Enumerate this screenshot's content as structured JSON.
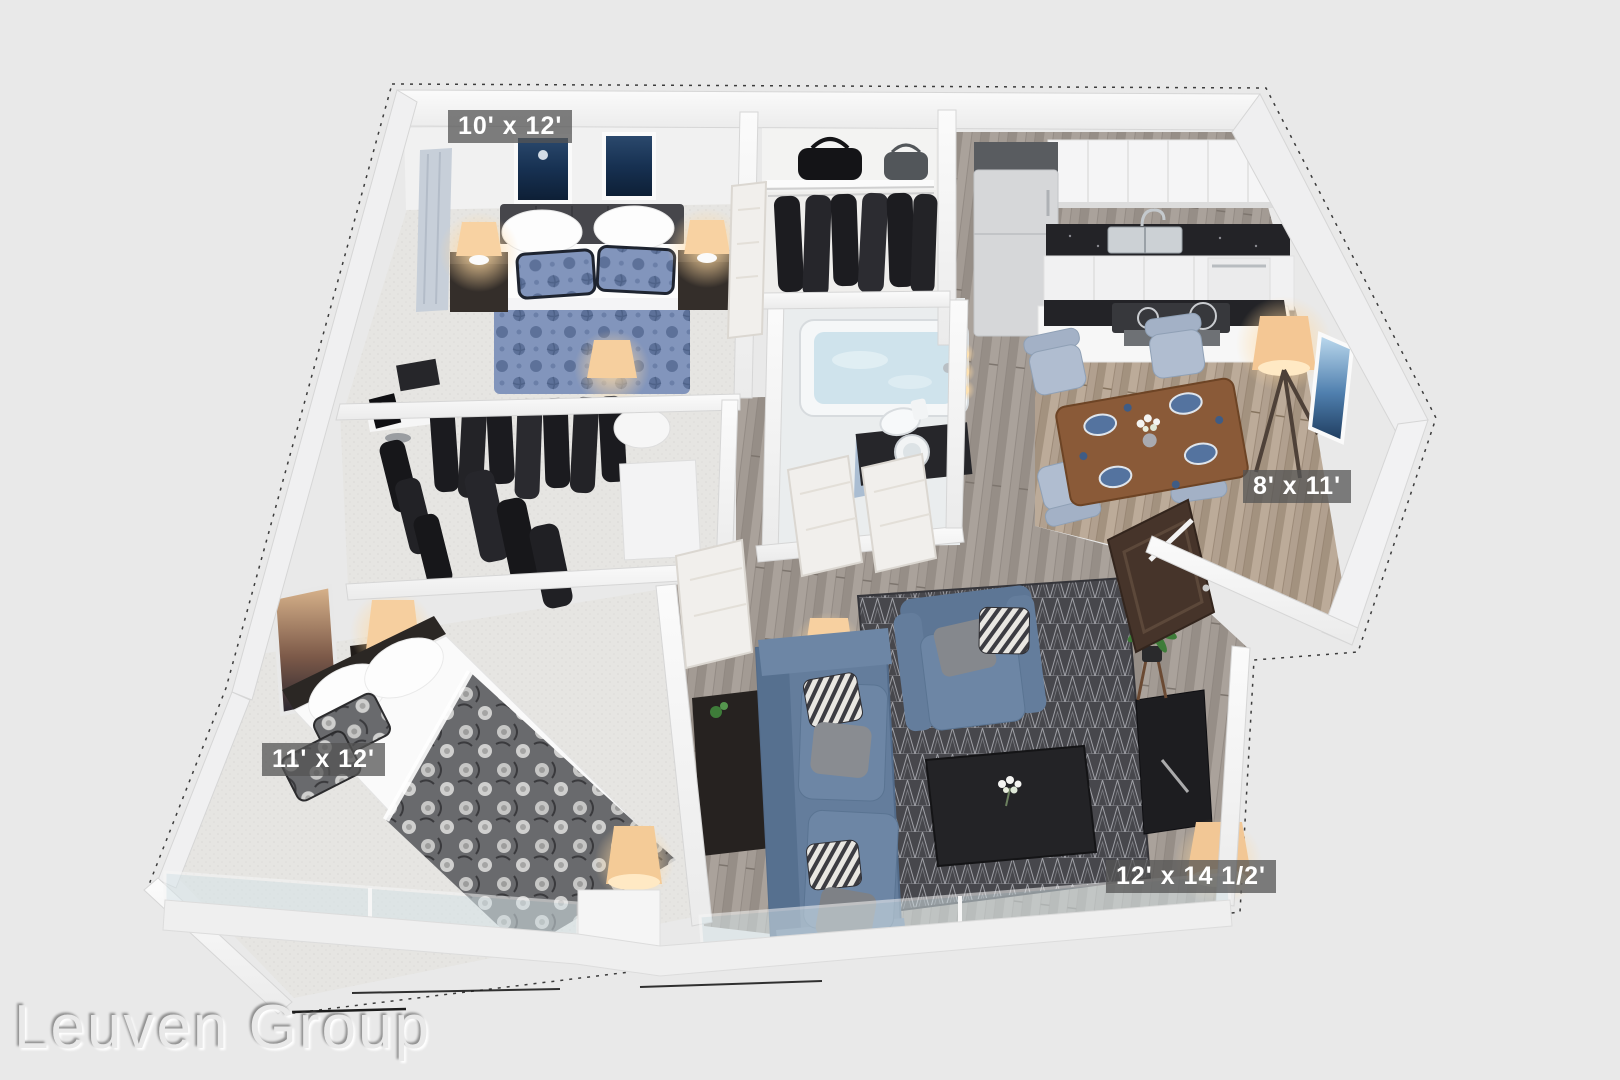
{
  "watermark": {
    "text": "Leuven Group"
  },
  "floorplan": {
    "type": "3d-apartment-floor-plan",
    "rooms": [
      {
        "id": "bedroom-1",
        "dimensions": "10' x 12'"
      },
      {
        "id": "dining-area",
        "dimensions": "8' x 11'"
      },
      {
        "id": "bedroom-2",
        "dimensions": "11' x 12'"
      },
      {
        "id": "living-room",
        "dimensions": "12' x 14 1/2'"
      }
    ],
    "colors": {
      "background": "#e9e9e9",
      "wall": "#f8f8f8",
      "label_background": "rgba(84,84,84,0.75)",
      "label_text": "#ffffff",
      "sofa_blue": "#6d86a5",
      "duvet_blue": "#8295bc",
      "duvet_gray": "#696a6d",
      "counter_black": "#232327",
      "dining_table_wood": "#8a5a38",
      "wood_floor": "#a39b94",
      "rug_dark": "#47474c",
      "lamp_glow": "#ffd9a0"
    }
  }
}
